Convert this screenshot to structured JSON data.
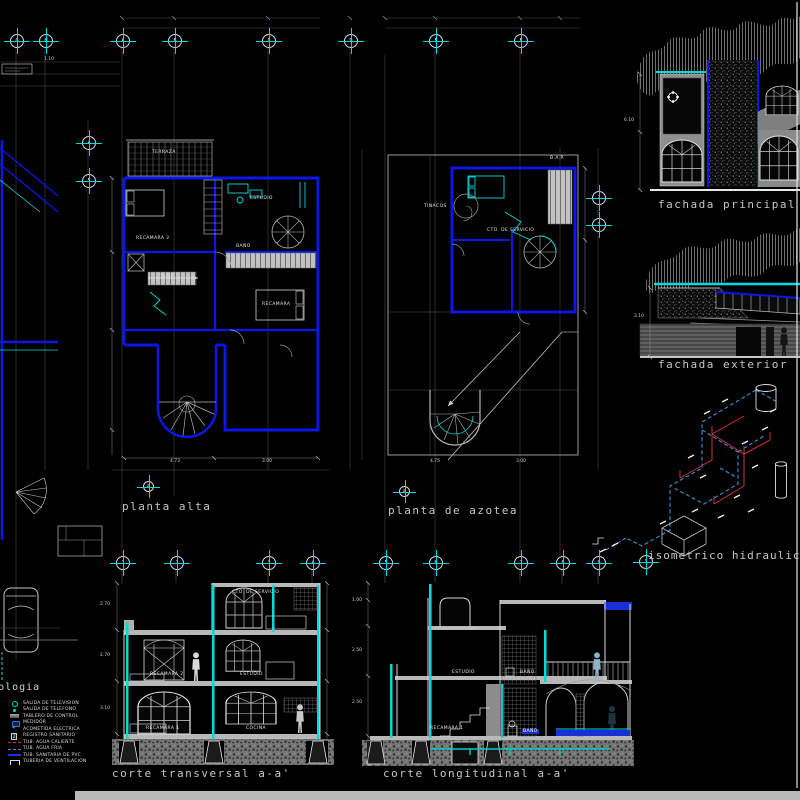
{
  "canvas": {
    "background": "#000000"
  },
  "titles": {
    "planta_alta": "planta alta",
    "planta_azotea": "planta de azotea",
    "fachada_principal": "fachada principal",
    "fachada_exterior": "fachada exterior",
    "isometrico": "isometrico hidraulico",
    "corte_transversal": "corte transversal a-a'",
    "corte_longitudinal": "corte longitudinal a-a'"
  },
  "rooms": {
    "terraza": "TERRAZA",
    "recamara2": "RECAMARA 2",
    "estudio": "ESTUDIO",
    "bano": "BAÑO",
    "recamara": "RECAMARA",
    "sube": "SUBE",
    "cto_servicio": "CTO. DE SERVICIO",
    "tinacos": "TINACOS",
    "bap": "B.A.P.",
    "recamara1": "RECAMARA 1",
    "cocina": "COCINA"
  },
  "sections": {
    "t": {
      "top": "CTO. DE SERVICIO",
      "mid_left": "RECAMARA 2",
      "mid_right": "ESTUDIO",
      "bot_left": "RECAMARA 1",
      "bot_right": "COCINA"
    },
    "l": {
      "mid_left": "ESTUDIO",
      "mid_right": "BAÑO",
      "bot_left": "RECAMARA 1",
      "bot_tag": "BAÑO"
    }
  },
  "grid": {
    "top": [
      "G",
      "H",
      "A",
      "B",
      "C",
      "D",
      "E",
      "F"
    ],
    "left": [
      "4",
      "5"
    ],
    "right": [
      "2",
      "3"
    ],
    "sec_t": [
      "1",
      "2",
      "3",
      "4"
    ],
    "sec_l": [
      "5",
      "6",
      "7",
      "8",
      "9"
    ],
    "cut": "a",
    "iso": "3"
  },
  "dims": {
    "d1": "4.73",
    "d2": "3.00",
    "d3": "4.75",
    "d4": "3.00",
    "d5": "1.10",
    "d6": "2.70",
    "d7": "2.70",
    "d8": "3.10",
    "d9": "1.00",
    "d10": "2.50",
    "d11": "2.50",
    "d12": "6.10",
    "d13": "3.10"
  },
  "legend": {
    "title": "simbologia",
    "items": [
      {
        "icon": "tv-outlet",
        "label": "SALIDA DE TELEVISION"
      },
      {
        "icon": "phone-outlet",
        "label": "SALIDA DE TELEFONO"
      },
      {
        "icon": "control-panel",
        "label": "TABLERO DE CONTROL"
      },
      {
        "icon": "meter",
        "label": "MEDIDOR"
      },
      {
        "icon": "electric-feed",
        "label": "ACOMETIDA ELECTRICA"
      },
      {
        "icon": "sanitary-register",
        "label": "REGISTRO SANITARIO"
      },
      {
        "icon": "hot-water-pipe",
        "label": "TUB. AGUA CALIENTE"
      },
      {
        "icon": "cold-water-pipe",
        "label": "TUB. AGUA FRIA"
      },
      {
        "icon": "pvc-pipe",
        "label": "TUB. SANITARIA DE PVC"
      },
      {
        "icon": "vent-pipe",
        "label": "TUBERIA DE VENTILACION"
      }
    ]
  },
  "colors": {
    "wall_blue": "#0b16e8",
    "cyan": "#00dcdc",
    "hot_red": "#d23333",
    "cold_blue": "#3f8fd2",
    "line_white": "#d8d8d8",
    "statusbar": "#b9b9b9"
  }
}
